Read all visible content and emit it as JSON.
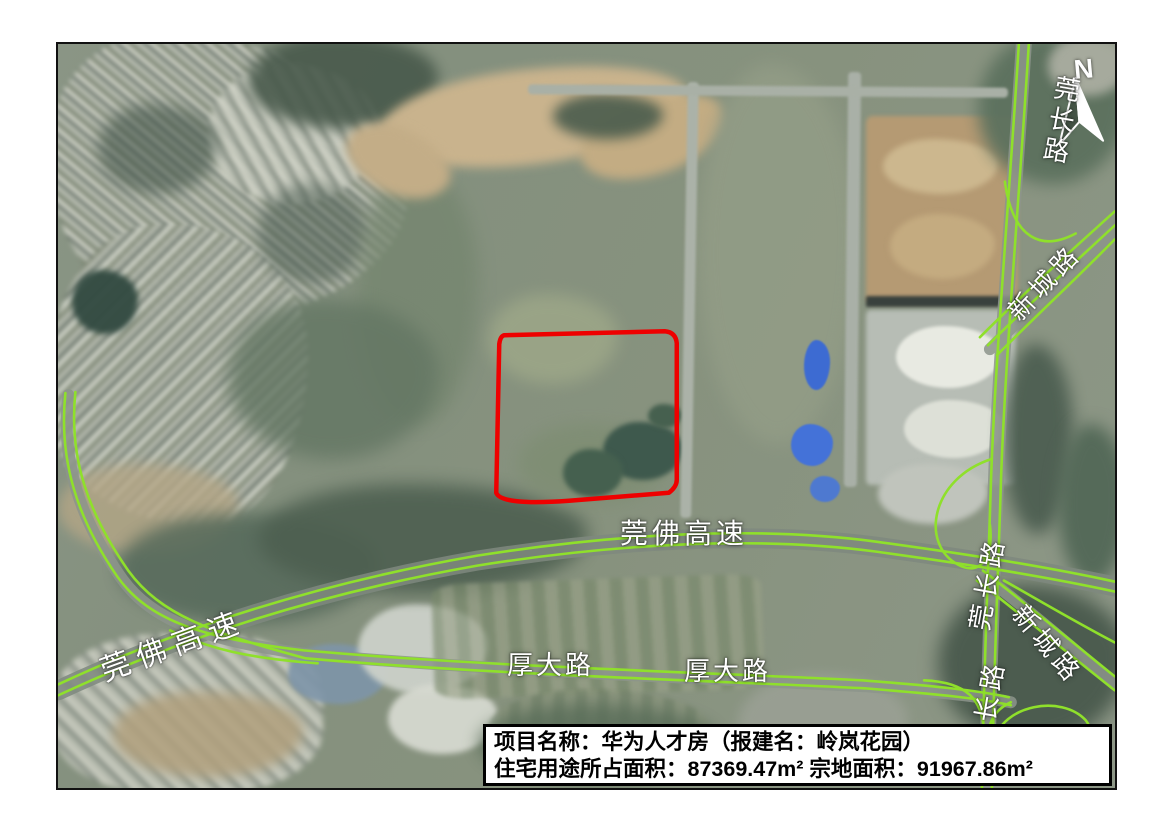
{
  "map": {
    "compass": {
      "label": "N"
    },
    "road_labels": [
      {
        "id": "guanfo-main",
        "text": "莞佛高速"
      },
      {
        "id": "guanfo-left",
        "text": "莞佛高速"
      },
      {
        "id": "houda-1",
        "text": "厚大路"
      },
      {
        "id": "houda-2",
        "text": "厚大路"
      },
      {
        "id": "guanchang-top",
        "text": "莞长路"
      },
      {
        "id": "guanchang-mid",
        "text": "莞长路"
      },
      {
        "id": "guanchang-bottom",
        "text": "莞长路"
      },
      {
        "id": "xincheng-top",
        "text": "新城路"
      },
      {
        "id": "xincheng-bottom",
        "text": "新城路"
      }
    ],
    "info_box": {
      "line1": "项目名称：华为人才房（报建名：岭岚花园）",
      "line2": "住宅用途所占面积：87369.47m² 宗地面积：91967.86m²"
    },
    "parcel": {
      "name": "岭岚花园地块红线",
      "residential_area_m2": "87369.47",
      "plot_area_m2": "91967.86"
    },
    "overlay_colors": {
      "road_line": "#8fe02b",
      "parcel_outline": "#ee0000"
    }
  }
}
